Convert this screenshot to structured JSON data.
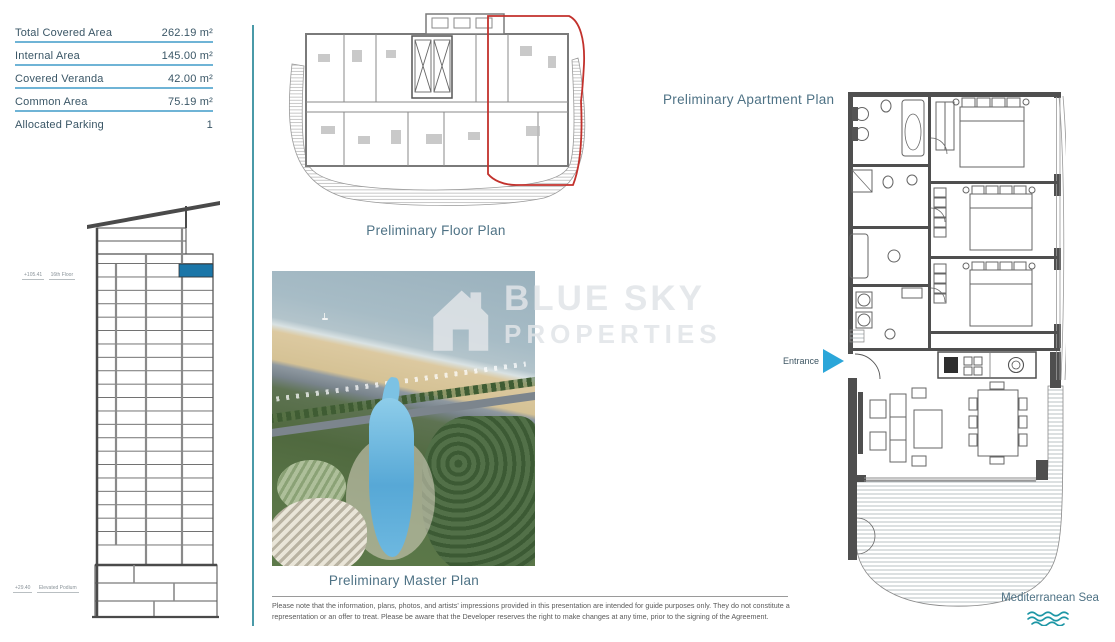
{
  "area_table": {
    "rows": [
      {
        "label": "Total Covered Area",
        "value": "262.19 m²"
      },
      {
        "label": "Internal Area",
        "value": "145.00 m²"
      },
      {
        "label": "Covered Veranda",
        "value": "42.00 m²"
      },
      {
        "label": "Common Area",
        "value": "75.19 m²"
      },
      {
        "label": "Allocated Parking",
        "value": "1"
      }
    ]
  },
  "tower": {
    "upper_marker": {
      "elevation": "+105.41",
      "label": "16th Floor"
    },
    "lower_marker": {
      "elevation": "+29.40",
      "label": "Elevated Podium"
    }
  },
  "plans": {
    "floor_plan_title": "Preliminary Floor Plan",
    "master_plan_title": "Preliminary Master Plan",
    "apartment_plan_title": "Preliminary Apartment Plan"
  },
  "apartment": {
    "entrance_label": "Entrance",
    "sea_label": "Mediterranean Sea"
  },
  "watermark": {
    "line1": "BLUE SKY",
    "line2": "PROPERTIES"
  },
  "disclaimer": "Please note that the information, plans, photos, and artists' impressions provided in this presentation are intended for guide purposes only. They do not constitute a representation or an offer to treat. Please be aware that the Developer reserves the right to make changes at any time, prior to the signing of the Agreement.",
  "colors": {
    "divider_teal": "#4a9aa8",
    "underline_blue": "#6fb4d6",
    "highlighted_floor_blue": "#1b76a8",
    "unit_outline_red": "#c2312c",
    "entrance_arrow_blue": "#2ba6d9",
    "wave_teal": "#1d96a5",
    "title_color": "#4e7285",
    "text_color": "#3a5666"
  }
}
